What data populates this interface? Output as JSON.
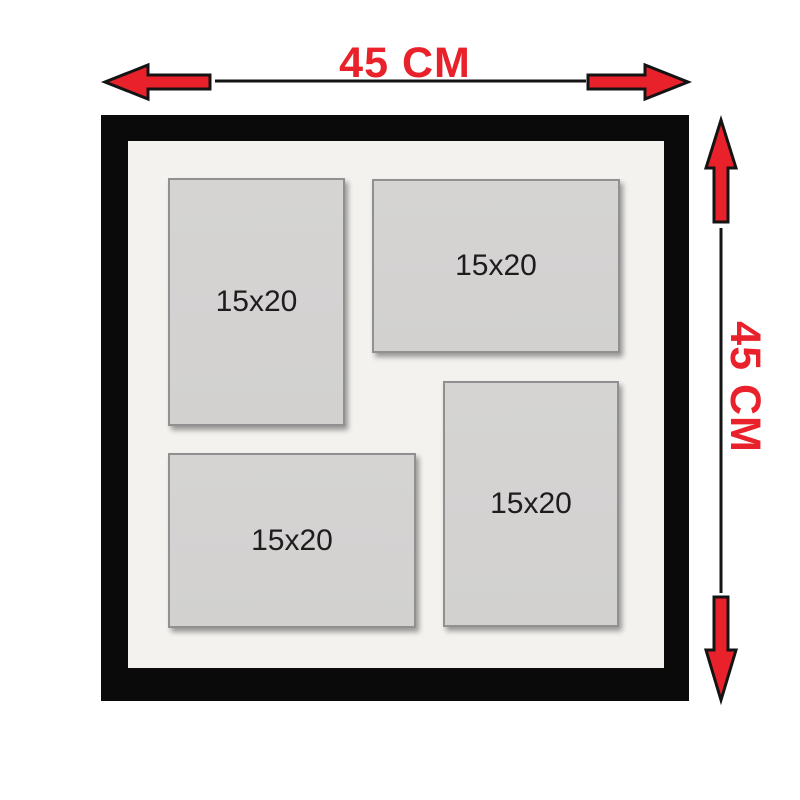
{
  "dimensions": {
    "width_label": "45 CM",
    "height_label": "45 CM"
  },
  "frame": {
    "openings": [
      {
        "label": "15x20",
        "orientation": "portrait",
        "position": "top-left"
      },
      {
        "label": "15x20",
        "orientation": "landscape",
        "position": "top-right"
      },
      {
        "label": "15x20",
        "orientation": "landscape",
        "position": "bottom-left"
      },
      {
        "label": "15x20",
        "orientation": "portrait",
        "position": "bottom-right"
      }
    ]
  },
  "colors": {
    "accent_red": "#e8212b",
    "dimension_line": "#141414",
    "frame_black": "#0b0a0a",
    "mat": "#f4f2ef",
    "opening_gray": "#d2d1d0",
    "opening_border": "#909090",
    "label_text": "#1d1d1d"
  }
}
